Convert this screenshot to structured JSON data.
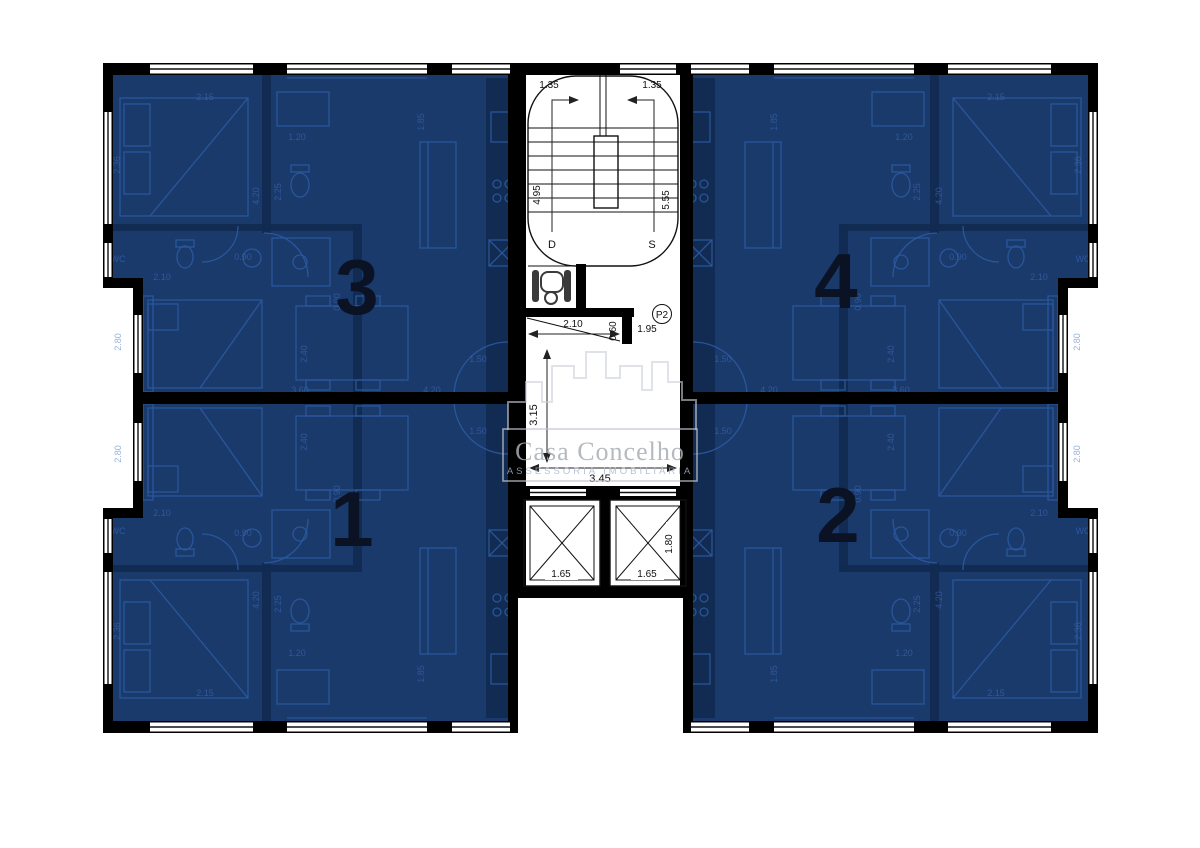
{
  "plan": {
    "watermark": {
      "title": "Casa Concelho",
      "subtitle": "ASSESSORIA IMOBILIÁRIA"
    },
    "units": [
      {
        "id": "3",
        "number": "3"
      },
      {
        "id": "4",
        "number": "4"
      },
      {
        "id": "1",
        "number": "1"
      },
      {
        "id": "2",
        "number": "2"
      }
    ],
    "stairwell": {
      "width_left": "1.35",
      "width_right": "1.35",
      "run_down": "4.95",
      "run_up": "5.55",
      "down_label": "D",
      "up_label": "S"
    },
    "vestibule": {
      "width": "2.10",
      "depth": "0.60",
      "door_width": "1.95",
      "level": "P2"
    },
    "hall": {
      "depth": "3.15",
      "width": "3.45"
    },
    "elevators": {
      "left_width": "1.65",
      "right_width": "1.65",
      "depth": "1.80"
    },
    "unit_dim_labels": [
      {
        "t": "2.15",
        "x": 205,
        "y": 100,
        "r": 0
      },
      {
        "t": "2.36",
        "x": 120,
        "y": 165,
        "r": -90
      },
      {
        "t": "1.20",
        "x": 297,
        "y": 140,
        "r": 0
      },
      {
        "t": "2.25",
        "x": 281,
        "y": 192,
        "r": -90
      },
      {
        "t": "4.20",
        "x": 259,
        "y": 196,
        "r": -90
      },
      {
        "t": "0.90",
        "x": 243,
        "y": 260,
        "r": 0
      },
      {
        "t": "2.10",
        "x": 162,
        "y": 280,
        "r": 0
      },
      {
        "t": "WC",
        "x": 118,
        "y": 262,
        "r": 0
      },
      {
        "t": "1.85",
        "x": 424,
        "y": 122,
        "r": -90
      },
      {
        "t": "2.40",
        "x": 307,
        "y": 354,
        "r": -90
      },
      {
        "t": "0.90",
        "x": 340,
        "y": 302,
        "r": -90
      },
      {
        "t": "2.80",
        "x": 121,
        "y": 342,
        "r": -90
      },
      {
        "t": "3.60",
        "x": 300,
        "y": 393,
        "r": 0
      },
      {
        "t": "4.20",
        "x": 432,
        "y": 393,
        "r": 0
      },
      {
        "t": "1.50",
        "x": 478,
        "y": 362,
        "r": 0
      }
    ],
    "colors": {
      "unit_fill": "#1a3a6c",
      "wall": "#000000",
      "furniture": "#2b5aa0",
      "partition": "#122a52",
      "dim_text": "#3f6fc0",
      "number": "#0a1224",
      "watermark": "#a8aeb6",
      "watermark_sub": "#a3b4cd"
    }
  }
}
